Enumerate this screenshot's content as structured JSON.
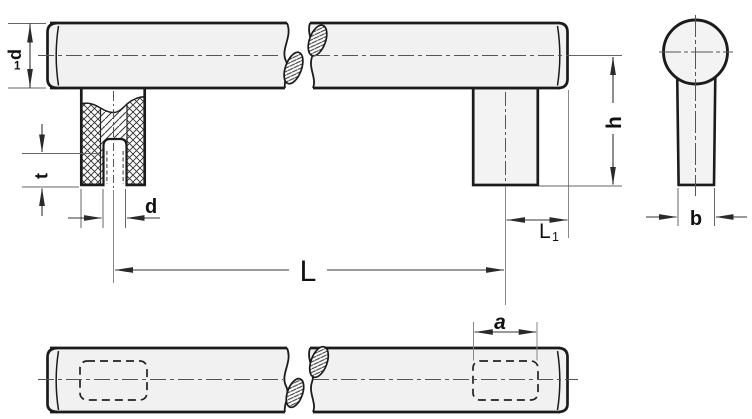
{
  "labels": {
    "d1": {
      "main": "d",
      "sub": "1"
    },
    "t": "t",
    "d": "d",
    "L": "L",
    "L1": {
      "main": "L",
      "sub": "1"
    },
    "h": "h",
    "b": "b",
    "a": "a"
  },
  "colors": {
    "outline": "#1b1b1b",
    "dimension": "#333333",
    "extension": "#888888",
    "centerline": "#555555",
    "tube_fill": "#f1f1f1",
    "leg_fill": "#f3f3f3",
    "background": "#ffffff"
  }
}
